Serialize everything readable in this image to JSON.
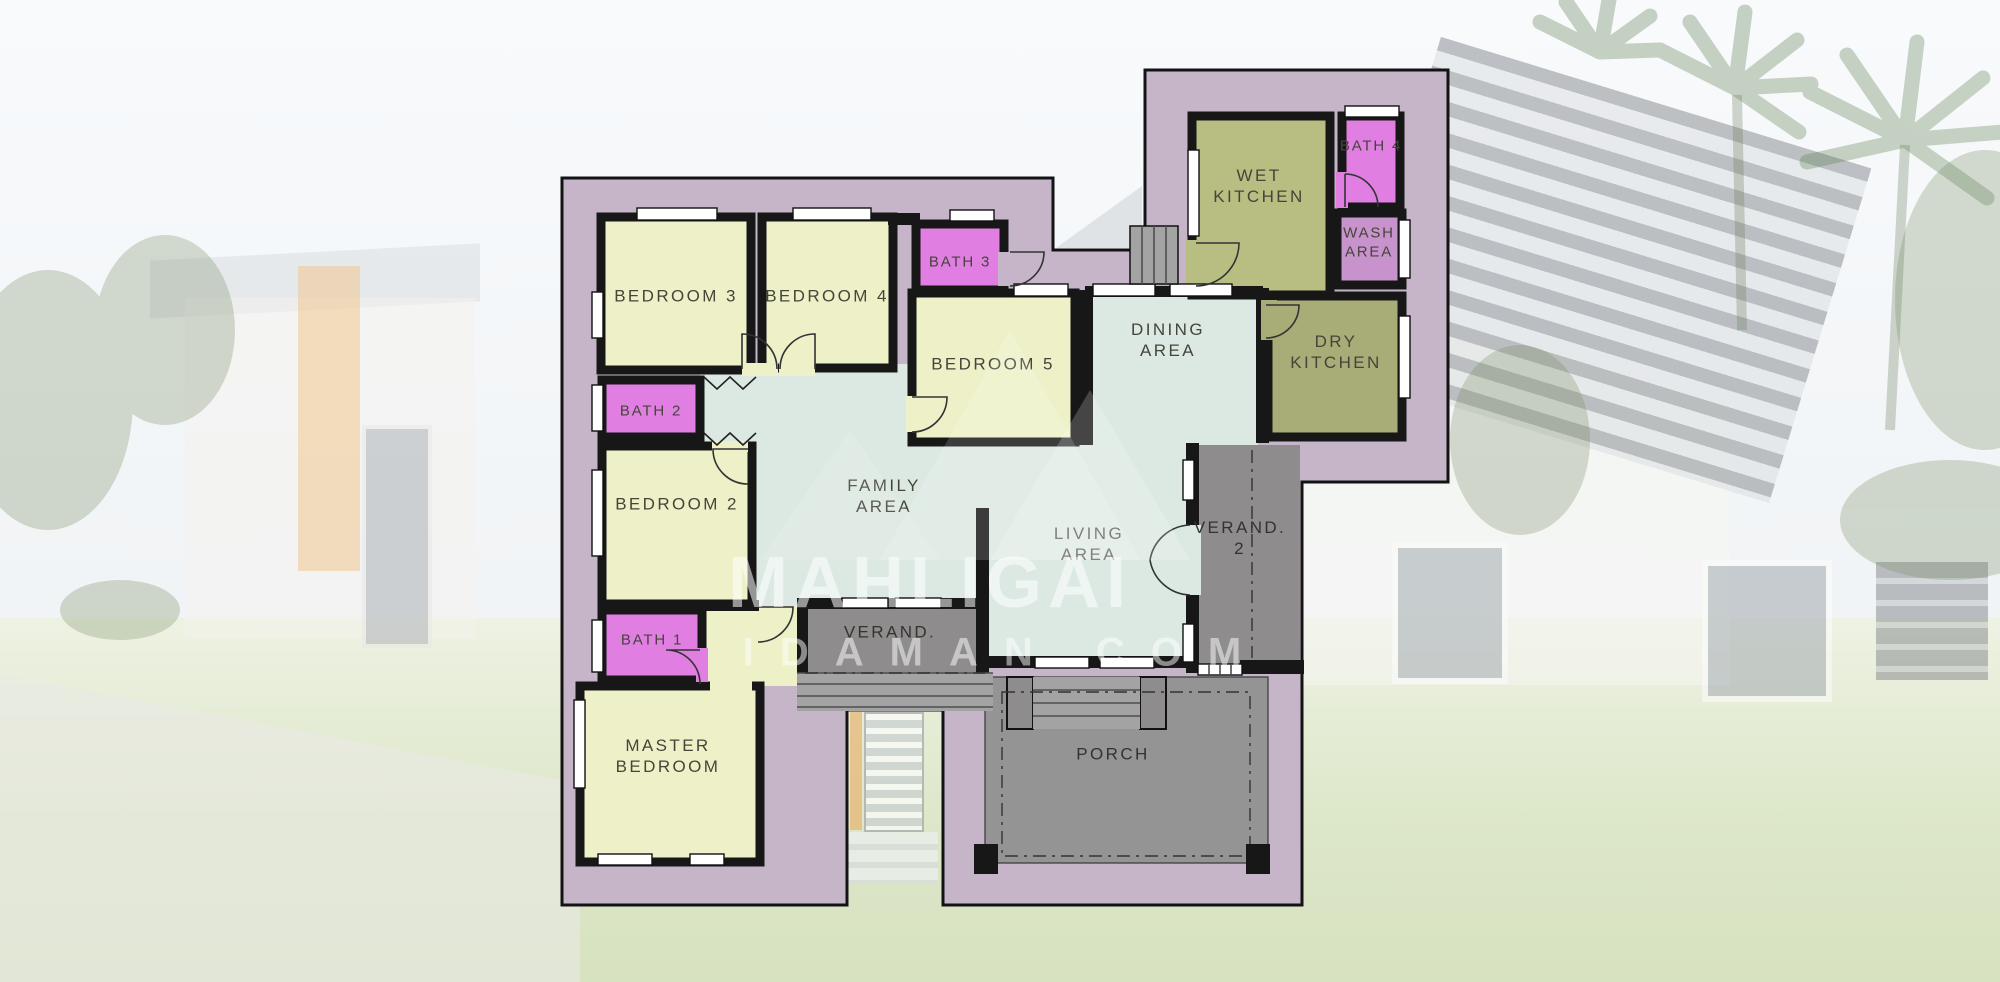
{
  "watermark": {
    "line1": "MAHLIGAI",
    "line2": "IDAMAN.COM"
  },
  "rooms": {
    "bedroom3": {
      "label": "BEDROOM 3"
    },
    "bedroom4": {
      "label": "BEDROOM 4"
    },
    "bath3": {
      "label": "BATH 3"
    },
    "bedroom5": {
      "label": "BEDROOM 5"
    },
    "bath2": {
      "label": "BATH 2"
    },
    "bedroom2": {
      "label": "BEDROOM 2"
    },
    "bath1": {
      "label": "BATH 1"
    },
    "master_bedroom": {
      "label": "MASTER BEDROOM"
    },
    "family_area": {
      "label": "FAMILY AREA"
    },
    "dining_area": {
      "label": "DINING AREA"
    },
    "living_area": {
      "label": "LIVING AREA"
    },
    "wet_kitchen": {
      "label": "WET KITCHEN"
    },
    "dry_kitchen": {
      "label": "DRY KITCHEN"
    },
    "bath4": {
      "label": "BATH 4"
    },
    "wash_area": {
      "label": "WASH AREA"
    },
    "verandah": {
      "label": "VERAND."
    },
    "verandah2": {
      "label": "VERAND. 2"
    },
    "porch": {
      "label": "PORCH"
    }
  },
  "colors": {
    "compound": "#c6b5c9",
    "room_yellow": "#eef1c8",
    "bath_pink": "#e07ee2",
    "wash_pink": "#c892cc",
    "mint": "#dce9e2",
    "olive": "#b8bd81",
    "olive_dark": "#a8ac77",
    "veranda_gray": "#8e8c8c",
    "porch_gray": "#949494",
    "step_gray": "#a3a3a3",
    "wall_dark": "#171717"
  }
}
